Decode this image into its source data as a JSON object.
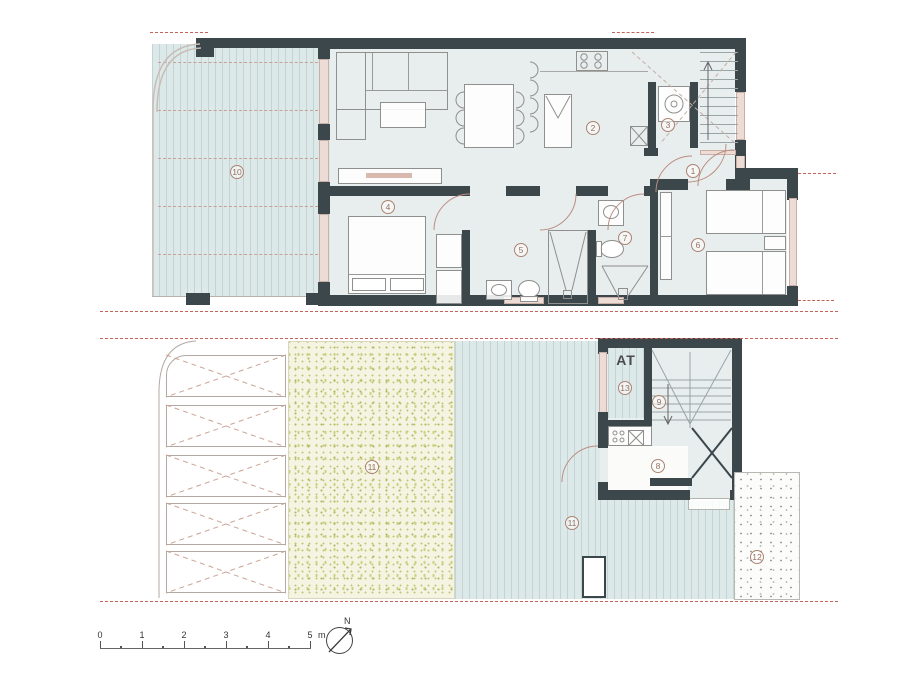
{
  "labels": {
    "north": "N",
    "at": "AT"
  },
  "scale_bar": {
    "ticks": [
      "0",
      "1",
      "2",
      "3",
      "4",
      "5"
    ],
    "unit": "m"
  },
  "rooms": [
    {
      "num": "1",
      "x": 693,
      "y": 171,
      "name": "entrance-hall"
    },
    {
      "num": "2",
      "x": 593,
      "y": 128,
      "name": "kitchen"
    },
    {
      "num": "3",
      "x": 668,
      "y": 125,
      "name": "laundry"
    },
    {
      "num": "4",
      "x": 388,
      "y": 207,
      "name": "bedroom-1"
    },
    {
      "num": "5",
      "x": 521,
      "y": 250,
      "name": "bathroom-1"
    },
    {
      "num": "6",
      "x": 698,
      "y": 245,
      "name": "bedroom-2"
    },
    {
      "num": "7",
      "x": 625,
      "y": 238,
      "name": "bathroom-2"
    },
    {
      "num": "8",
      "x": 658,
      "y": 466,
      "name": "summer-kitchen"
    },
    {
      "num": "9",
      "x": 659,
      "y": 402,
      "name": "staircase"
    },
    {
      "num": "10",
      "x": 237,
      "y": 172,
      "name": "upper-terrace"
    },
    {
      "num": "11",
      "x": 372,
      "y": 467,
      "name": "garden"
    },
    {
      "num": "11",
      "x": 572,
      "y": 523,
      "name": "deck-terrace"
    },
    {
      "num": "12",
      "x": 757,
      "y": 557,
      "name": "gravel-patio"
    },
    {
      "num": "13",
      "x": 625,
      "y": 388,
      "name": "storage"
    }
  ],
  "colors": {
    "wall": "#3b474a",
    "floor": "#e8edee",
    "deck": "#dde8e9",
    "deck_stripe": "#c3d4d7",
    "garden": "#f5f4e3",
    "window": "#eddbd5",
    "boundary_dash": "#c4635a",
    "door_arc": "#bb8d80"
  }
}
